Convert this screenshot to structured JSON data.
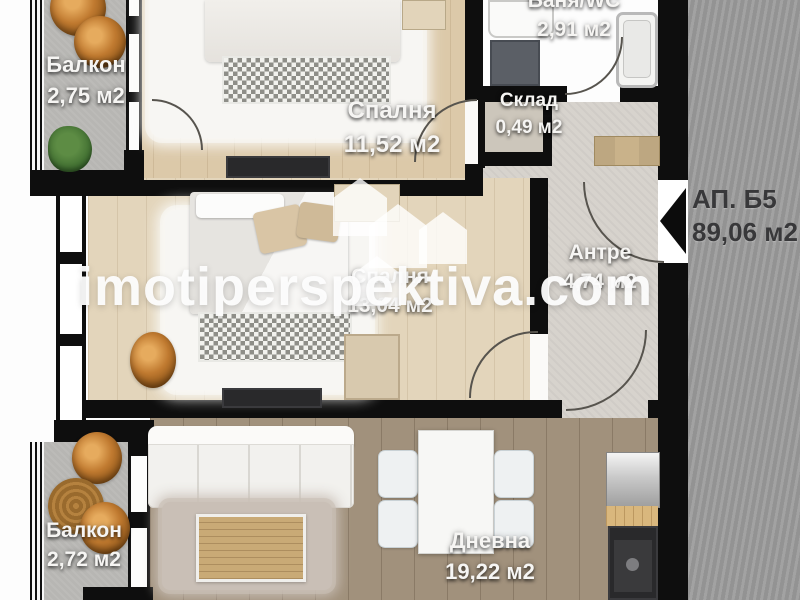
{
  "watermark": {
    "text": "imotiperspektiva.com"
  },
  "apartment": {
    "name": "АП. Б5",
    "area": "89,06 м2"
  },
  "rooms": {
    "balcony_top": {
      "name": "Балкон",
      "area": "2,75 м2"
    },
    "bedroom_top": {
      "name": "Спалня",
      "area": "11,52 м2"
    },
    "bathroom": {
      "name": "Баня/WC",
      "area": "2,91 м2"
    },
    "storage": {
      "name": "Склад",
      "area": "0,49 м2"
    },
    "hallway": {
      "name": "Антре",
      "area": "4,74 м2"
    },
    "bedroom_mid": {
      "name": "Спалня",
      "area": "13,04 м2"
    },
    "living": {
      "name": "Дневна",
      "area": "19,22 м2"
    },
    "balcony_bottom": {
      "name": "Балкон",
      "area": "2,72 м2"
    }
  },
  "colors": {
    "wall": "#0e0e0e",
    "wood_light": "#dcc9a9",
    "wood_mid": "#e3d5bb",
    "wood_dark": "#a1917c",
    "balcony_floor": "#b7b6b3",
    "bathroom_tile": "#eceded",
    "hallway_floor": "#d7d3cd",
    "common_area": "#9b9b9b",
    "chair_accent": "#c07a30",
    "label_text": "#f6f5f3",
    "apartment_label_text": "#38383a",
    "watermark_text": "#fdfdfd"
  }
}
